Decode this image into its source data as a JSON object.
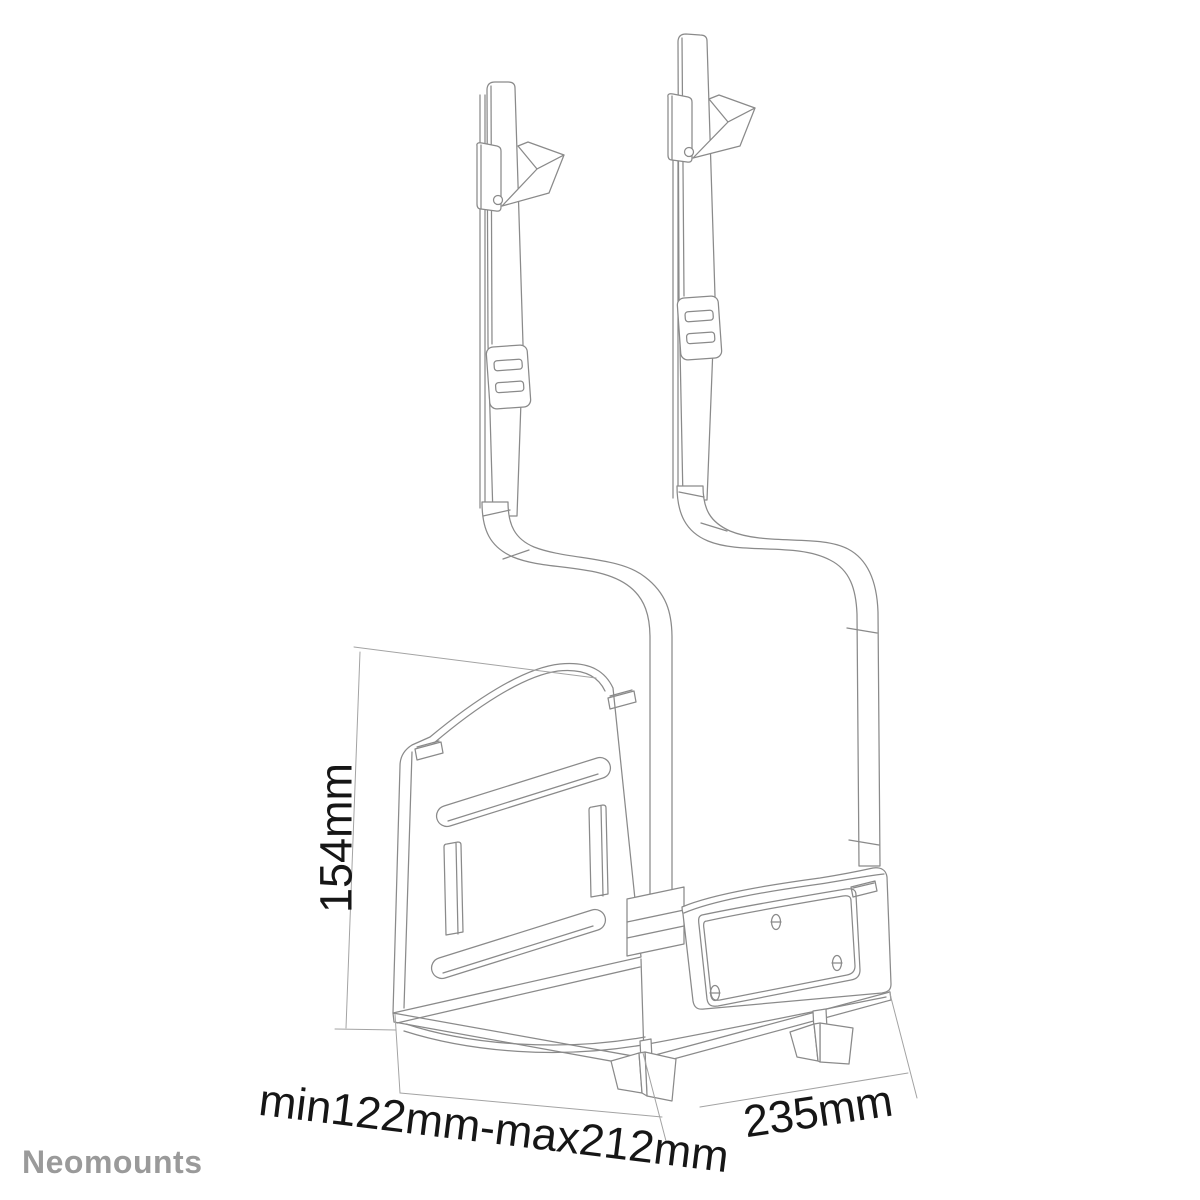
{
  "diagram": {
    "brand": "Neomounts",
    "dimension_labels": {
      "height": "154mm",
      "depth_range": "min122mm-max212mm",
      "width": "235mm"
    },
    "colors": {
      "drawing_line": "#8a8a8a",
      "dimension_line": "#a3a3a3",
      "dimension_text": "#161616",
      "brand_text": "#9a9a9a",
      "background": "#ffffff"
    }
  }
}
